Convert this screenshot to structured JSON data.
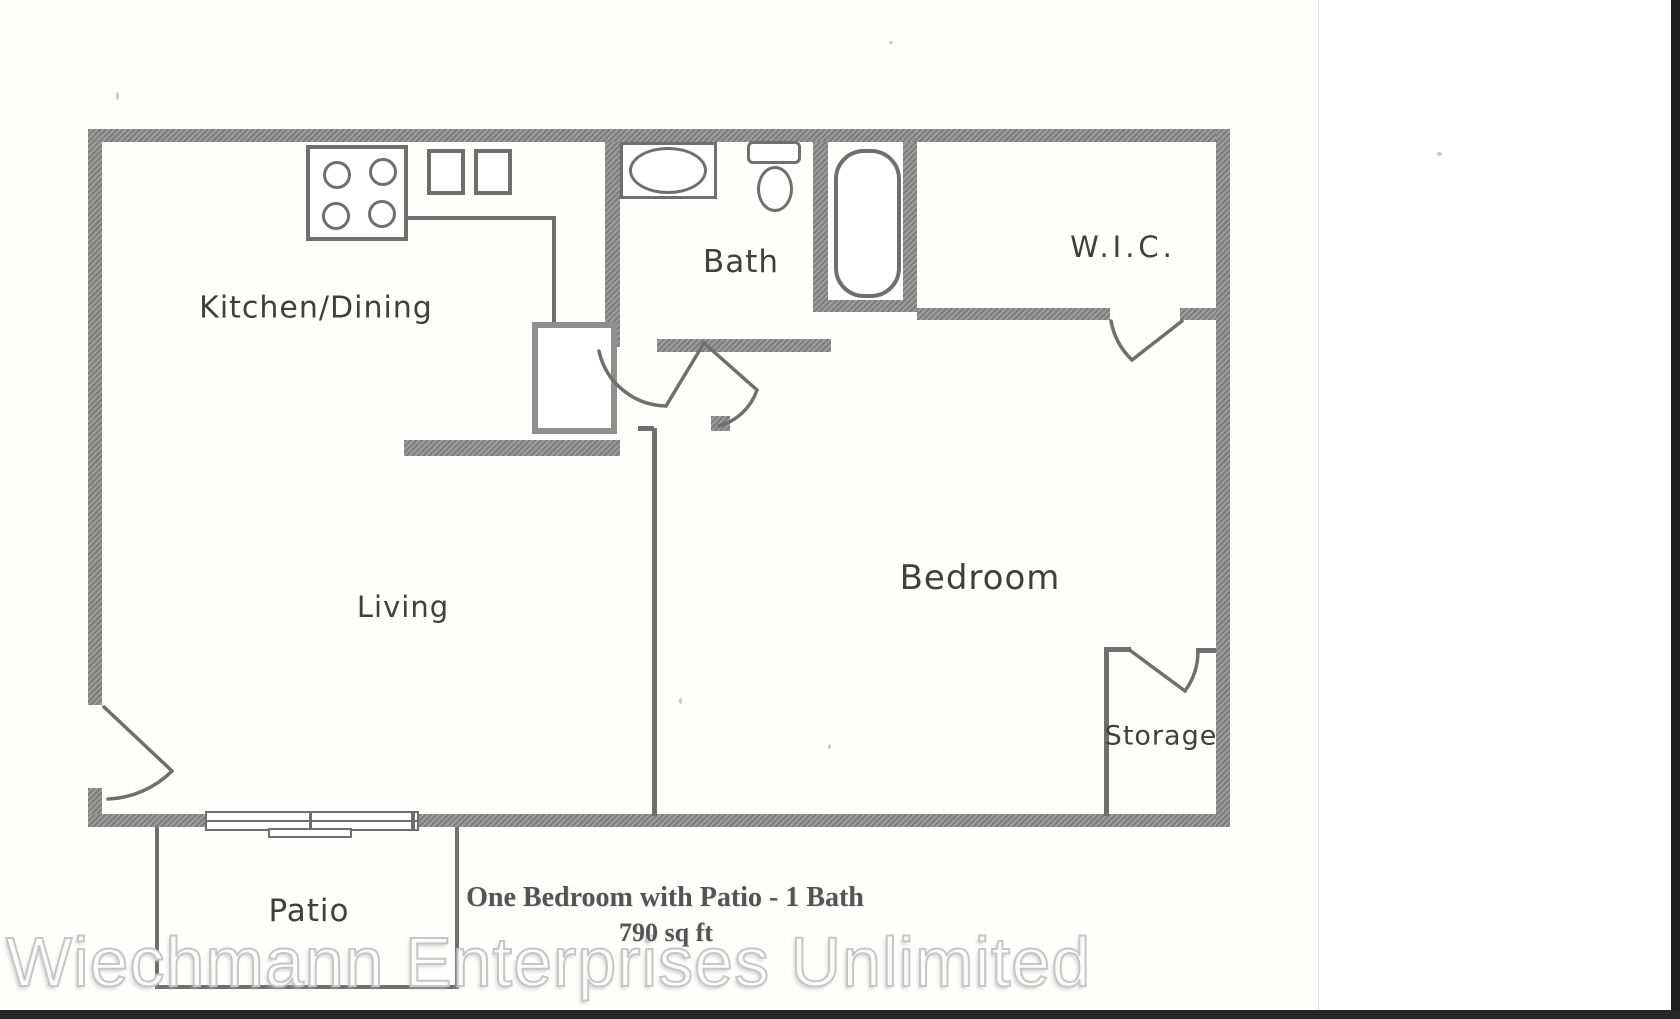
{
  "rooms": {
    "kitchen_dining": "Kitchen/Dining",
    "bath": "Bath",
    "wic": "W.I.C.",
    "living": "Living",
    "bedroom": "Bedroom",
    "storage": "Storage",
    "patio": "Patio"
  },
  "caption": {
    "line1": "One Bedroom with Patio - 1 Bath",
    "line2": "790 sq ft"
  },
  "watermark": {
    "text": "Wiechmann Enterprises Unlimited"
  },
  "icons": {
    "stove": "stove-icon",
    "kitchen_sinks": "double-sink-icon",
    "bath_sink": "bathroom-sink-icon",
    "toilet": "toilet-icon",
    "bathtub": "bathtub-icon",
    "sliding_door": "sliding-patio-door-icon"
  },
  "colors": {
    "wall": "#8f8f8f",
    "line": "#6f6f6f",
    "label": "#3f3f3f",
    "caption": "#545454",
    "watermark_stroke": "#c6c6c6"
  }
}
